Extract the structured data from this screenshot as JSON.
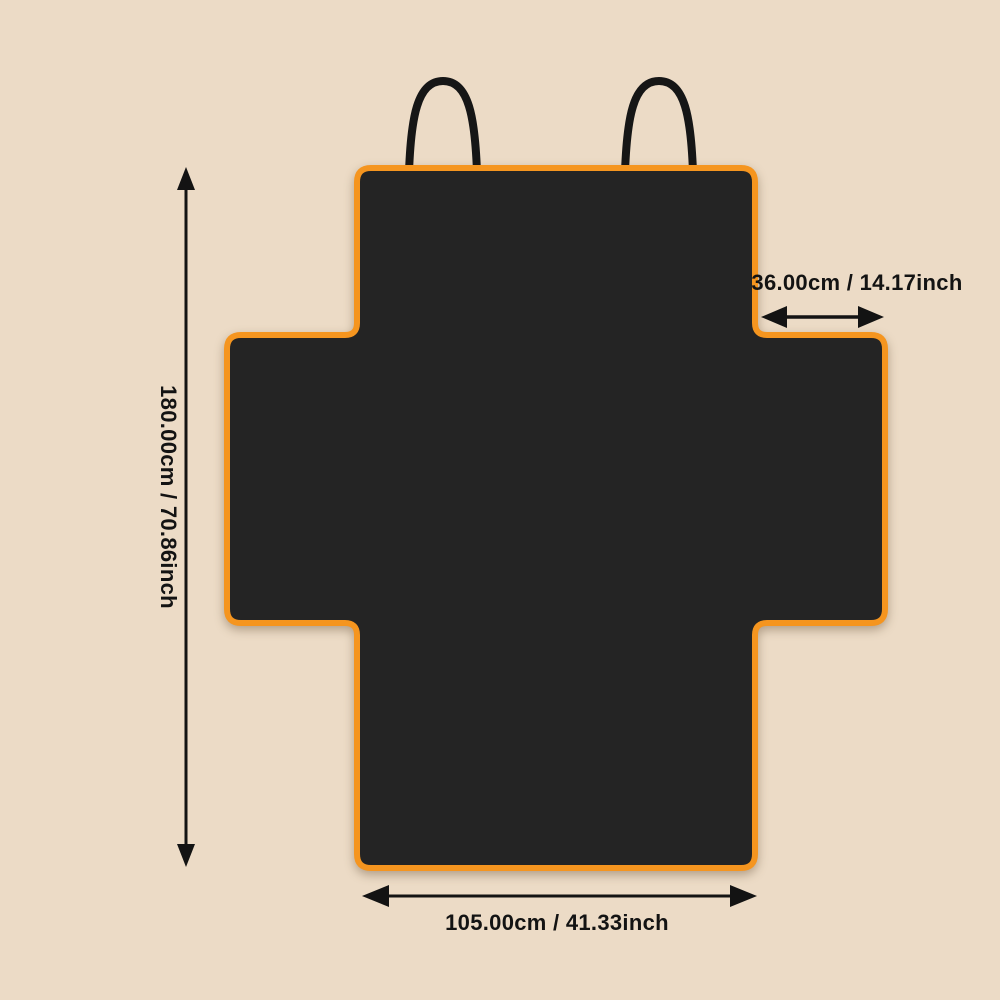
{
  "labels": {
    "height": "180.00cm / 70.86inch",
    "flap_width": "36.00cm / 14.17inch",
    "bottom_width": "105.00cm / 41.33inch"
  },
  "measurements": {
    "height_cm": 180.0,
    "height_inch": 70.86,
    "flap_cm": 36.0,
    "flap_inch": 14.17,
    "bottom_width_cm": 105.0,
    "bottom_width_inch": 41.33
  },
  "colors": {
    "background": "#ecdbc6",
    "cover_fill": "#242424",
    "cover_border": "#f5951f",
    "strap": "#161616",
    "dimension": "#131313"
  }
}
